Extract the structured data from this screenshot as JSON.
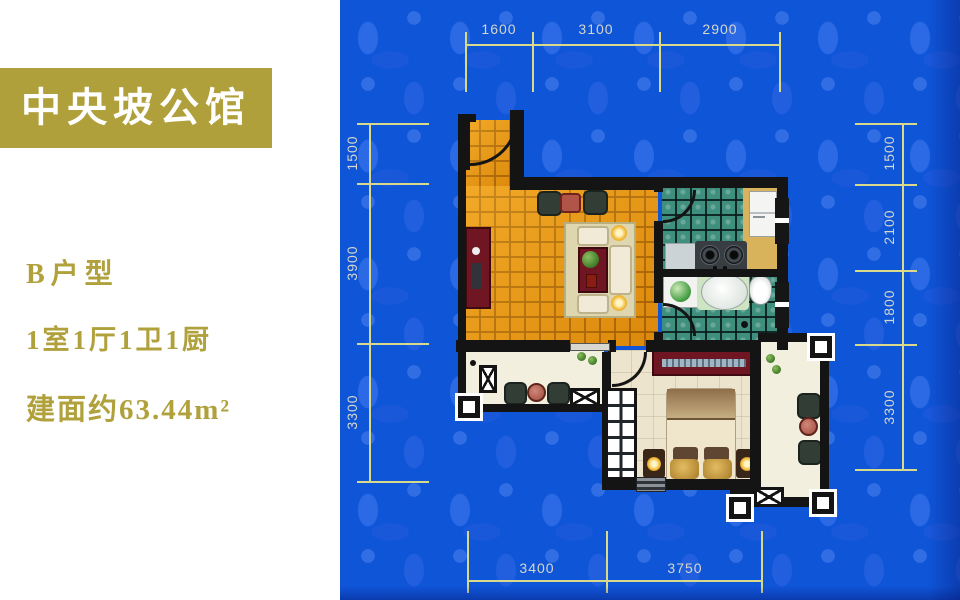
{
  "title_banner": {
    "text": "中央坡公馆"
  },
  "listing": {
    "unit_type": "B户型",
    "layout": "1室1厅1卫1厨",
    "area": "建面约63.44m²"
  },
  "floor_plan": {
    "dimensions": {
      "top": [
        "1600",
        "3100",
        "2900"
      ],
      "left": [
        "1500",
        "3900",
        "3300"
      ],
      "right": [
        "1500",
        "2100",
        "1800",
        "3300"
      ],
      "bottom": [
        "3400",
        "3750"
      ]
    }
  },
  "colors": {
    "background": "#0f55d8",
    "banner_bg": "#b0a03c",
    "banner_text": "#ffffff",
    "listing_text": "#b1a13d",
    "dim_line": "#d9d98c",
    "dim_text": "#d6d6cc",
    "wall": "#141414",
    "living_floor": "#e8940f",
    "tile_floor": "#3f8f7f",
    "bedroom_floor": "#ece4cc",
    "balcony_floor": "#f3efdf",
    "counter": "#d9b35c",
    "accent_red": "#701522"
  }
}
